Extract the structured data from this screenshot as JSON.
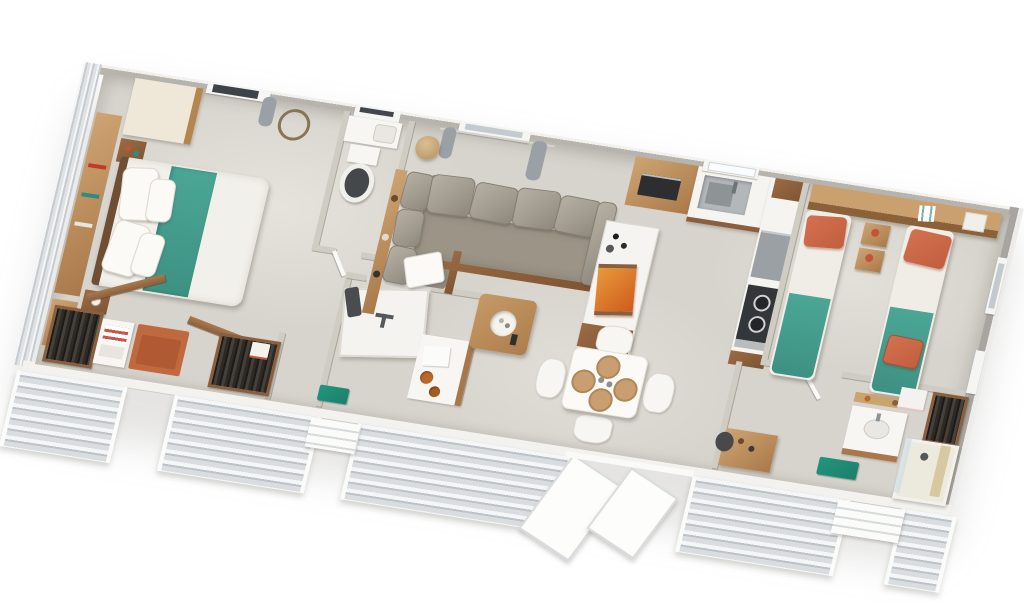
{
  "scene": {
    "type": "3d-floorplan-render",
    "description": "Top-down 3D rendering of a long rectangular mobile home / holiday lodge floor plan, rotated on a white background, with gray clapboard siding on the front wall",
    "background_color": "#ffffff",
    "rotation_deg": 9
  },
  "palette": {
    "floor_concrete": "#d7d4cd",
    "interior_wall": "#cfccc3",
    "exterior_wall_top": "#f2f1ed",
    "right_end_wall": "#a8a5a0",
    "siding_light": "#f5f6f7",
    "siding_dark": "#bdc2c6",
    "wood_light": "#c49a6a",
    "wood_dark": "#8a5f3f",
    "sofa_gray": "#a29b8f",
    "bedspread_teal": "#3f9488",
    "pillow_coral": "#cc6a4d",
    "mat_terracotta": "#c0693f",
    "mat_teal": "#1f8a74",
    "marble_counter": "#f6f4f0",
    "appliance_dark": "#34373a",
    "steel": "#b3b7ba",
    "toilet_seat": "#45484b"
  },
  "rooms": [
    {
      "name": "master-bedroom",
      "furniture": [
        "double-bed-teal-runner",
        "headboard-shelf",
        "wardrobe",
        "nightstand",
        "nightstand",
        "desk",
        "desk-chair",
        "window",
        "wall-basket"
      ]
    },
    {
      "name": "wc",
      "furniture": [
        "toilet",
        "basin-shelf",
        "window"
      ]
    },
    {
      "name": "dressing-entry",
      "furniture": [
        "open-wardrobe-clothes",
        "towel-dresser",
        "terracotta-entry-mat",
        "open-wardrobe-clothes"
      ]
    },
    {
      "name": "bathroom-1",
      "furniture": [
        "shower",
        "washstand-copper-bowls",
        "teal-bath-mat",
        "dark-towel"
      ]
    },
    {
      "name": "living-room",
      "furniture": [
        "corner-sofa",
        "console-shelf",
        "pendant-lamp",
        "coffee-table-decor-bowl",
        "window-with-curtains",
        "throw-pillow"
      ]
    },
    {
      "name": "kitchen",
      "furniture": [
        "tall-cabinet-microwave",
        "sink",
        "window",
        "counter-run",
        "dishwasher",
        "gas-hob",
        "island-counter",
        "orange-food-tray",
        "bottles"
      ]
    },
    {
      "name": "dining-area",
      "furniture": [
        "square-table",
        "chair",
        "chair",
        "chair",
        "chair",
        "rattan-placemats"
      ]
    },
    {
      "name": "twin-bedroom",
      "furniture": [
        "twin-bed-1",
        "twin-bed-2",
        "overhead-shelf",
        "nightstand-pair",
        "coral-throw",
        "window",
        "window"
      ]
    },
    {
      "name": "bathroom-2",
      "furniture": [
        "vanity-sink",
        "mirror-shelf",
        "shower-cabin",
        "wardrobe-clothes",
        "white-towels",
        "teal-bath-mat",
        "desk",
        "desk-chair"
      ]
    }
  ],
  "openings": {
    "front": [
      "entry-door-1",
      "entry-door-2-with-step",
      "patio-sliding-doors-open",
      "entry-door-3-with-step"
    ],
    "windows": [
      "master-window",
      "wc-window",
      "living-window",
      "kitchen-window",
      "twin-right-window-1",
      "twin-right-window-2"
    ]
  }
}
